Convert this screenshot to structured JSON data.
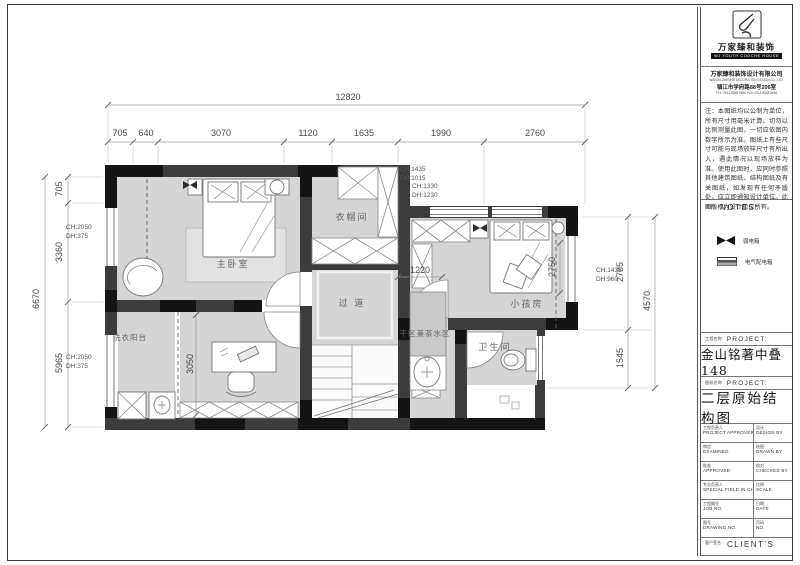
{
  "title_block": {
    "logo": {
      "wordmark": "万家臻和装饰",
      "tagline": "WJ YOUTH CODCHE HOUSE",
      "company": "万家臻和装饰设计有限公司",
      "company_sub": "WANJIA ZHENHE DECORATION DESIGN CO.,LTD.",
      "address": "镇江市学府路88号206室",
      "phone": "TEL: 0511-8888 6666  FAX: 0511-8888 6666"
    },
    "notes": "注：本图纸均以公制为单位，所有尺寸用毫米计算。切勿以比例测量此图，一切应依图内数字所示为准。图纸上有些尺寸可能与现场放样尺寸有所出入，遇此情况以现场放样为准。使用此图时，应同时参照其他建筑图纸、结构图纸及有关图纸，如发现有任何矛盾处，应立即通知设计单位。此图版权为设计单位所有。",
    "notes_label": {
      "zh": "说明",
      "en": "NOTES:"
    },
    "legend": {
      "items": [
        {
          "icon": "weak-current-box",
          "label": "弱电箱"
        },
        {
          "icon": "distribution-box",
          "label": "电气配电箱"
        }
      ]
    },
    "project": {
      "label_zh": "工程名称",
      "label_en": "PROJECT:",
      "value": "金山铭著中叠148"
    },
    "drawing": {
      "label_zh": "图纸名称",
      "label_en": "PROJECT:",
      "value": "二层原始结构图"
    },
    "table_rows": [
      {
        "l_zh": "工程负责人",
        "l_en": "PROJECT APPROVER",
        "r_zh": "设计",
        "r_en": "DESIGN BY"
      },
      {
        "l_zh": "审定",
        "l_en": "EXAMINED",
        "r_zh": "绘图",
        "r_en": "DRAWN BY"
      },
      {
        "l_zh": "批准",
        "l_en": "APPROVED",
        "r_zh": "校对",
        "r_en": "CHECKED BY"
      },
      {
        "l_zh": "专业负责人",
        "l_en": "SPECIAL FIELD IN CHARGE",
        "r_zh": "比例",
        "r_en": "SCALE"
      },
      {
        "l_zh": "工程编号",
        "l_en": "JOB NO.",
        "r_zh": "日期",
        "r_en": "DATE"
      },
      {
        "l_zh": "图号",
        "l_en": "DRAWING NO.",
        "r_zh": "页码",
        "r_en": "NO."
      }
    ],
    "client": {
      "zh": "客户签名",
      "en": "CLIENT'S"
    }
  },
  "plan": {
    "rooms": [
      {
        "label": "主卧室"
      },
      {
        "label": "衣帽间"
      },
      {
        "label": "过 道"
      },
      {
        "label": "小孩房"
      },
      {
        "label": "卫生间"
      },
      {
        "label": "干区兼茶水区"
      },
      {
        "label": "洗衣阳台"
      }
    ],
    "dims": {
      "overall_width": "12820",
      "top_segments": [
        "705",
        "640",
        "3070",
        "1120",
        "1635",
        "1990",
        "2760"
      ],
      "left_overall": "6670",
      "left_segments": [
        "705",
        "3360",
        "5965"
      ],
      "right_overall": "4570",
      "right_segments": [
        "2785",
        "1545"
      ],
      "interior": {
        "study_depth": "3050",
        "dry_width": "1220",
        "kid_depth": "2750"
      }
    },
    "windows": [
      {
        "ch": "CH:2050",
        "dh": "DH:375"
      },
      {
        "ch": "CH:2050",
        "dh": "DH:375"
      },
      {
        "ch": "CH:1435",
        "dh": "DH:1015"
      },
      {
        "ch": "CH:1330",
        "dh": "DH:1230"
      },
      {
        "ch": "CH:1435",
        "dh": "DH:960"
      }
    ],
    "colors": {
      "wall": "#3c3c3c",
      "wall_black": "#141414",
      "room_fill": "#d5d5d5",
      "dim_text": "#4a4a4a"
    }
  }
}
